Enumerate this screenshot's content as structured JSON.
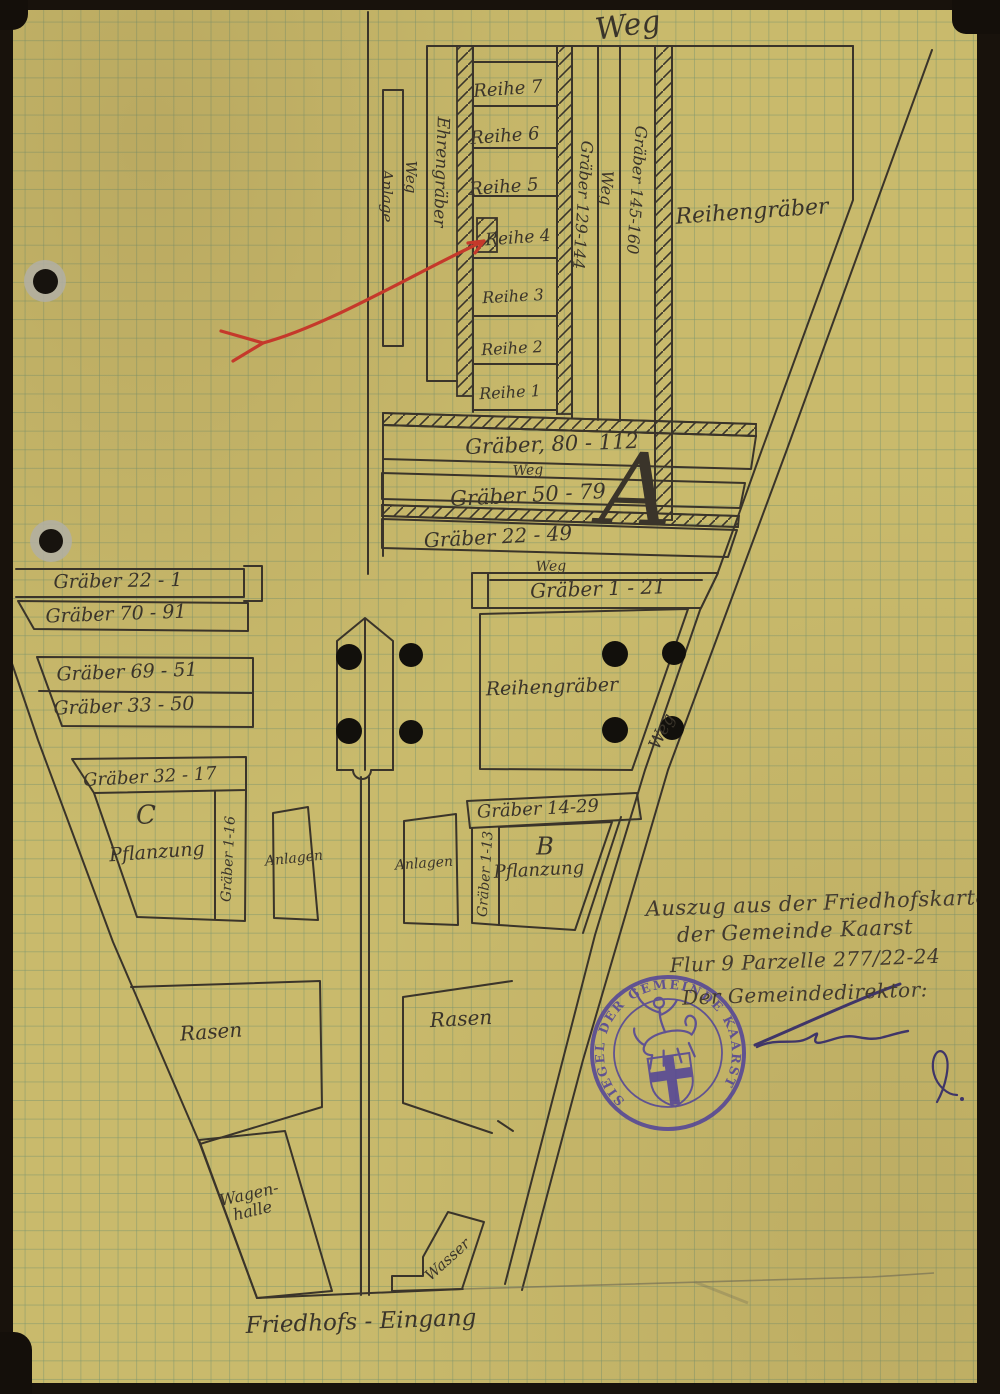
{
  "colors": {
    "paper": "#c9ba6c",
    "grid": "#7a946e",
    "ink": "#3a342a",
    "red_arrow": "#c5392b",
    "seal": "#4c3e9b",
    "signature": "#3f3568"
  },
  "labels": {
    "weg_top": "Weg",
    "rows": [
      "Reihe 7",
      "Reihe 6",
      "Reihe 5",
      "Reihe 4",
      "Reihe 3",
      "Reihe 2",
      "Reihe 1"
    ],
    "ehrengraeber": "Ehrengräber",
    "weg_vertical": "Weg",
    "anlage": "Anlage",
    "graeber_129_144": "Gräber 129-144",
    "weg_column": "Weg",
    "graeber_145_160": "Gräber 145-160",
    "reihengraeber_upper": "Reihengräber",
    "graeber_80_112": "Gräber, 80 - 112",
    "weg_1": "Weg",
    "graeber_50_79": "Gräber 50 - 79",
    "graeber_22_49": "Gräber 22 - 49",
    "weg_2": "Weg",
    "graeber_1_21": "Gräber 1 - 21",
    "section_a": "A",
    "graeber_22_1": "Gräber 22 - 1",
    "graeber_70_91": "Gräber 70 - 91",
    "graeber_69_51": "Gräber 69 - 51",
    "graeber_33_50": "Gräber 33 - 50",
    "reihengraeber_mid": "Reihengräber",
    "weg_diagonal": "Weg",
    "graeber_32_17": "Gräber 32 - 17",
    "section_c": "C",
    "pflanzung_c": "Pflanzung",
    "graeber_1_16": "Gräber 1-16",
    "anlagen_west": "Anlagen",
    "anlagen_mid": "Anlagen",
    "graeber_14_29": "Gräber 14-29",
    "section_b": "B",
    "pflanzung_b": "Pflanzung",
    "graeber_1_13": "Gräber 1-13",
    "rasen_west": "Rasen",
    "rasen_east": "Rasen",
    "wagenhalle_line1": "Wagen-",
    "wagenhalle_line2": "halle",
    "wasser": "Wasser",
    "friedhofs_eingang": "Friedhofs - Eingang"
  },
  "note": {
    "line1": "Auszug aus der Friedhofskarte",
    "line2": "der Gemeinde Kaarst",
    "line3": "Flur 9 Parzelle 277/22-24",
    "line4": "Der Gemeindedirektor:"
  },
  "seal": {
    "ring_text": "SIEGEL DER GEMEINDE KAARST"
  }
}
